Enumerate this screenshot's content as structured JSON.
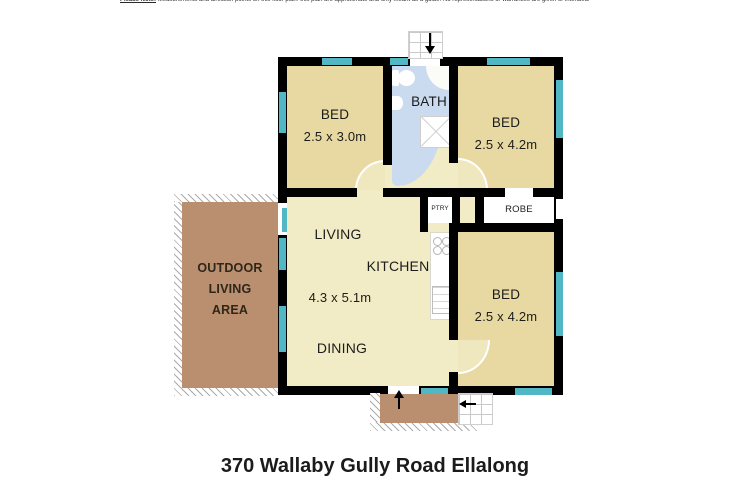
{
  "disclaimer": {
    "prefix": "Please Note:",
    "body": "Measurements and direction points on this floor plan: this plan are approximate and only meant as a guide. No representations or warranties are given or intended."
  },
  "title": "370 Wallaby Gully Road Ellalong",
  "colors": {
    "wall": "#000000",
    "bedroom_fill": "#e7d9a1",
    "living_fill": "#f1ecc6",
    "bath_fill": "#cadbef",
    "window": "#52b7c4",
    "deck": "#ba8f70",
    "text": "#1c1c1c"
  },
  "rooms": {
    "bed1": {
      "label": "BED",
      "dims": "2.5 x 3.0m"
    },
    "bed2": {
      "label": "BED",
      "dims": "2.5 x 4.2m"
    },
    "bed3": {
      "label": "BED",
      "dims": "2.5 x 4.2m"
    },
    "bath": {
      "label": "BATH"
    },
    "living": {
      "label": "LIVING"
    },
    "kitchen": {
      "label": "KITCHEN"
    },
    "living_dims": "4.3 x 5.1m",
    "dining": {
      "label": "DINING"
    },
    "pantry": {
      "label": "PTRY"
    },
    "robe": {
      "label": "ROBE"
    },
    "outdoor": {
      "line1": "OUTDOOR",
      "line2": "LIVING",
      "line3": "AREA"
    }
  }
}
